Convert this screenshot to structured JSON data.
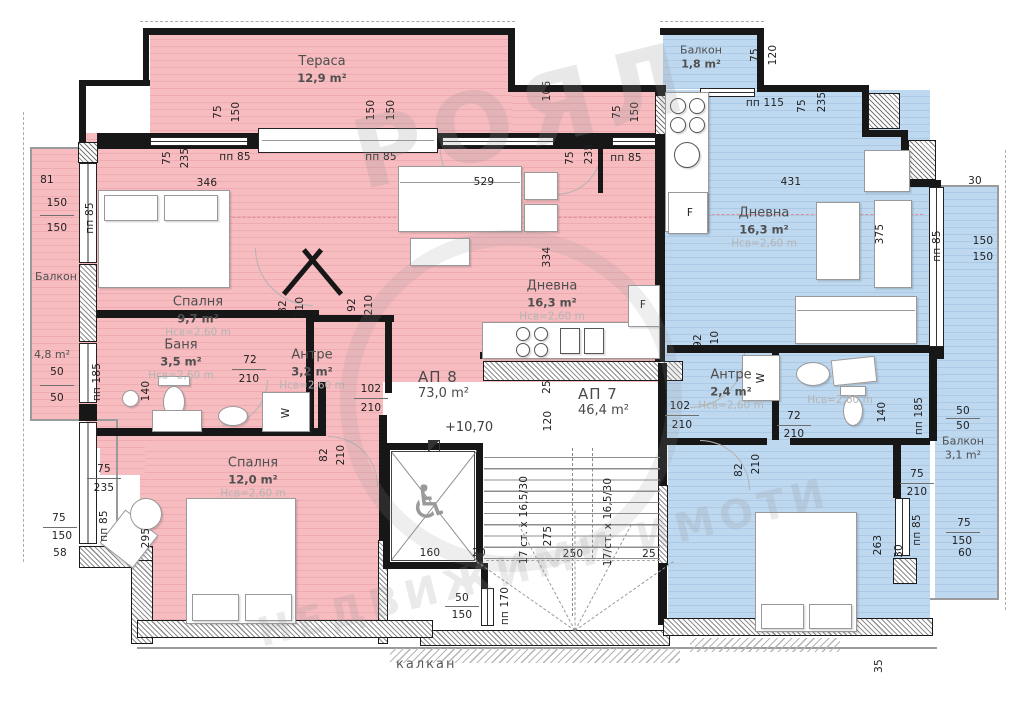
{
  "colors": {
    "apartment_ap8_fill": "#f6bcc0",
    "apartment_ap7_fill": "#bed8f0",
    "wall": "#171717",
    "red_dashed_line": "#df9097",
    "label_grey": "#4f4f4f",
    "height_note_grey": "#b4b4b4"
  },
  "apartments": {
    "ap8": {
      "label": "АП 8",
      "area": "73,0 m²",
      "level_mark": "+10,70"
    },
    "ap7": {
      "label": "АП 7",
      "area": "46,4 m²"
    }
  },
  "rooms": {
    "terrace": {
      "name": "Тераса",
      "area": "12,9 m²"
    },
    "balcony_left": {
      "name": "Балкон",
      "area": "4,8 m²"
    },
    "bedroom_nw": {
      "name": "Спалня",
      "area": "9,7 m²",
      "clear_height": "Нсв=2,60 m"
    },
    "bath_ap8": {
      "name": "Баня",
      "area": "3,5 m²",
      "clear_height": "Нсв=2,60 m"
    },
    "hall_ap8": {
      "name": "Антре",
      "area": "3,2 m²",
      "clear_height": "Нсв=2,60 m"
    },
    "living_ap8": {
      "name": "Дневна",
      "area": "16,3 m²",
      "clear_height": "Нсв=2,60 m"
    },
    "bedroom_sw": {
      "name": "Спалня",
      "area": "12,0 m²",
      "clear_height": "Нсв=2,60 m"
    },
    "balcony_top": {
      "name": "Балкон",
      "area": "1,8 m²"
    },
    "living_ap7": {
      "name": "Дневна",
      "area": "16,3 m²",
      "clear_height": "Нсв=2,60 m"
    },
    "hall_ap7": {
      "name": "Антре",
      "area": "2,4 m²",
      "clear_height": "Нсв=2,60 m"
    },
    "bath_ap7": {
      "clear_height": "Нсв=2,60 m"
    },
    "balcony_right": {
      "name": "Балкон",
      "area": "3,1 m²"
    }
  },
  "site": {
    "party_wall_label": "калкан"
  },
  "watermark": {
    "line1": "РОЯЛ",
    "line2": "НЕДВИЖИМИ ИМОТИ"
  },
  "annotations": {
    "dims": [
      {
        "t": "81",
        "x": 47,
        "y": 180
      },
      {
        "t": "150",
        "x": 57,
        "y": 203
      },
      {
        "t": "150",
        "x": 57,
        "y": 228
      },
      {
        "t": "50",
        "x": 57,
        "y": 372
      },
      {
        "t": "50",
        "x": 57,
        "y": 398
      },
      {
        "t": "пп 185",
        "x": 97,
        "y": 382,
        "r": 1
      },
      {
        "t": "пп 85",
        "x": 90,
        "y": 218,
        "r": 1
      },
      {
        "t": "75",
        "x": 167,
        "y": 158,
        "r": 1
      },
      {
        "t": "235",
        "x": 185,
        "y": 158,
        "r": 1
      },
      {
        "t": "346",
        "x": 207,
        "y": 183
      },
      {
        "t": "пп 85",
        "x": 235,
        "y": 157
      },
      {
        "t": "75",
        "x": 218,
        "y": 112,
        "r": 1
      },
      {
        "t": "150",
        "x": 236,
        "y": 112,
        "r": 1
      },
      {
        "t": "150",
        "x": 371,
        "y": 110,
        "r": 1
      },
      {
        "t": "150",
        "x": 391,
        "y": 110,
        "r": 1
      },
      {
        "t": "пп 85",
        "x": 381,
        "y": 157
      },
      {
        "t": "106",
        "x": 547,
        "y": 91,
        "r": 1
      },
      {
        "t": "75",
        "x": 617,
        "y": 112,
        "r": 1
      },
      {
        "t": "150",
        "x": 635,
        "y": 112,
        "r": 1
      },
      {
        "t": "75",
        "x": 570,
        "y": 158,
        "r": 1
      },
      {
        "t": "235",
        "x": 589,
        "y": 154,
        "r": 1
      },
      {
        "t": "пп 85",
        "x": 626,
        "y": 158
      },
      {
        "t": "529",
        "x": 484,
        "y": 182
      },
      {
        "t": "334",
        "x": 547,
        "y": 257,
        "r": 1
      },
      {
        "t": "82",
        "x": 283,
        "y": 307,
        "r": 1
      },
      {
        "t": "210",
        "x": 300,
        "y": 307,
        "r": 1
      },
      {
        "t": "92",
        "x": 352,
        "y": 305,
        "r": 1
      },
      {
        "t": "210",
        "x": 369,
        "y": 305,
        "r": 1
      },
      {
        "t": "72",
        "x": 250,
        "y": 360
      },
      {
        "t": "210",
        "x": 249,
        "y": 379
      },
      {
        "t": "140",
        "x": 146,
        "y": 391,
        "r": 1
      },
      {
        "t": "102",
        "x": 371,
        "y": 389
      },
      {
        "t": "210",
        "x": 371,
        "y": 408
      },
      {
        "t": "82",
        "x": 324,
        "y": 455,
        "r": 1
      },
      {
        "t": "210",
        "x": 341,
        "y": 455,
        "r": 1
      },
      {
        "t": "75",
        "x": 104,
        "y": 469
      },
      {
        "t": "235",
        "x": 104,
        "y": 488
      },
      {
        "t": "75",
        "x": 59,
        "y": 518
      },
      {
        "t": "150",
        "x": 62,
        "y": 536
      },
      {
        "t": "58",
        "x": 60,
        "y": 553
      },
      {
        "t": "пп 85",
        "x": 104,
        "y": 526,
        "r": 1
      },
      {
        "t": "295",
        "x": 146,
        "y": 538,
        "r": 1
      },
      {
        "t": "75",
        "x": 755,
        "y": 55,
        "r": 1
      },
      {
        "t": "120",
        "x": 773,
        "y": 55,
        "r": 1
      },
      {
        "t": "пп 115",
        "x": 765,
        "y": 103
      },
      {
        "t": "75",
        "x": 802,
        "y": 106,
        "r": 1
      },
      {
        "t": "235",
        "x": 822,
        "y": 102,
        "r": 1
      },
      {
        "t": "431",
        "x": 791,
        "y": 182
      },
      {
        "t": "375",
        "x": 880,
        "y": 234,
        "r": 1
      },
      {
        "t": "пп 85",
        "x": 937,
        "y": 246,
        "r": 1
      },
      {
        "t": "30",
        "x": 975,
        "y": 181
      },
      {
        "t": "150",
        "x": 983,
        "y": 241
      },
      {
        "t": "150",
        "x": 983,
        "y": 257
      },
      {
        "t": "92",
        "x": 698,
        "y": 341,
        "r": 1
      },
      {
        "t": "210",
        "x": 715,
        "y": 341,
        "r": 1
      },
      {
        "t": "102",
        "x": 680,
        "y": 406
      },
      {
        "t": "210",
        "x": 682,
        "y": 425
      },
      {
        "t": "72",
        "x": 794,
        "y": 416
      },
      {
        "t": "210",
        "x": 794,
        "y": 434
      },
      {
        "t": "140",
        "x": 882,
        "y": 412,
        "r": 1
      },
      {
        "t": "пп 185",
        "x": 919,
        "y": 416,
        "r": 1
      },
      {
        "t": "50",
        "x": 963,
        "y": 411
      },
      {
        "t": "50",
        "x": 963,
        "y": 426
      },
      {
        "t": "75",
        "x": 917,
        "y": 474
      },
      {
        "t": "210",
        "x": 917,
        "y": 492
      },
      {
        "t": "пп 85",
        "x": 917,
        "y": 530,
        "r": 1
      },
      {
        "t": "30",
        "x": 899,
        "y": 551,
        "r": 1
      },
      {
        "t": "75",
        "x": 964,
        "y": 523
      },
      {
        "t": "150",
        "x": 962,
        "y": 541
      },
      {
        "t": "60",
        "x": 965,
        "y": 553
      },
      {
        "t": "263",
        "x": 878,
        "y": 545,
        "r": 1
      },
      {
        "t": "82",
        "x": 739,
        "y": 470,
        "r": 1
      },
      {
        "t": "210",
        "x": 756,
        "y": 464,
        "r": 1
      },
      {
        "t": "35",
        "x": 879,
        "y": 666,
        "r": 1
      },
      {
        "t": "160",
        "x": 430,
        "y": 553
      },
      {
        "t": "20",
        "x": 479,
        "y": 553
      },
      {
        "t": "50",
        "x": 462,
        "y": 598
      },
      {
        "t": "150",
        "x": 462,
        "y": 615
      },
      {
        "t": "пп 170",
        "x": 505,
        "y": 606,
        "r": 1
      },
      {
        "t": "275",
        "x": 548,
        "y": 536,
        "r": 1
      },
      {
        "t": "250",
        "x": 573,
        "y": 554
      },
      {
        "t": "25",
        "x": 649,
        "y": 554
      },
      {
        "t": "25",
        "x": 547,
        "y": 387,
        "r": 1
      },
      {
        "t": "120",
        "x": 548,
        "y": 421,
        "r": 1
      },
      {
        "t": "17 ст. х 16,5/30",
        "x": 524,
        "y": 520,
        "r": 1
      },
      {
        "t": "17/ст. х 16,5/30",
        "x": 608,
        "y": 522,
        "r": 1
      },
      {
        "t": "F",
        "x": 643,
        "y": 305
      },
      {
        "t": "F",
        "x": 690,
        "y": 213
      },
      {
        "t": "W",
        "x": 286,
        "y": 413,
        "r": 1
      },
      {
        "t": "W",
        "x": 761,
        "y": 378,
        "r": 1
      }
    ]
  }
}
